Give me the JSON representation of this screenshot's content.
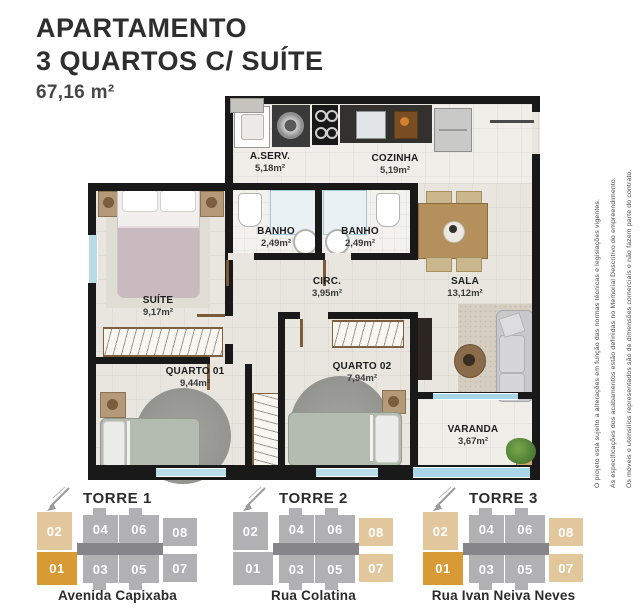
{
  "header": {
    "line1": "APARTAMENTO",
    "line2": "3 QUARTOS C/ SUÍTE",
    "area": "67,16 m²"
  },
  "disclaimer": {
    "line1": "Os móveis e utensílios representados são de dimensões comerciais e não fazem parte do contrato.",
    "line2": "As especificações dos acabamentos estão definidas no Memorial Descritivo do empreendimento.",
    "line3": "O projeto está sujeito a alterações em função das normas técnicas e legislações vigentes."
  },
  "floorplan": {
    "rooms": [
      {
        "name": "A.SERV.",
        "area": "5,18m²"
      },
      {
        "name": "COZINHA",
        "area": "5,19m²"
      },
      {
        "name": "BANHO",
        "area": "2,49m²"
      },
      {
        "name": "BANHO",
        "area": "2,49m²"
      },
      {
        "name": "CIRC.",
        "area": "3,95m²"
      },
      {
        "name": "SALA",
        "area": "13,12m²"
      },
      {
        "name": "SUÍTE",
        "area": "9,17m²"
      },
      {
        "name": "QUARTO 01",
        "area": "9,44m²"
      },
      {
        "name": "QUARTO 02",
        "area": "7,94m²"
      },
      {
        "name": "VARANDA",
        "area": "3,67m²"
      }
    ]
  },
  "towers": [
    {
      "name": "TORRE 1",
      "street": "Avenida Capixaba",
      "units": [
        {
          "label": "02",
          "color": "beige"
        },
        {
          "label": "04",
          "color": "gray"
        },
        {
          "label": "06",
          "color": "gray"
        },
        {
          "label": "08",
          "color": "gray"
        },
        {
          "label": "01",
          "color": "orange"
        },
        {
          "label": "03",
          "color": "gray"
        },
        {
          "label": "05",
          "color": "gray"
        },
        {
          "label": "07",
          "color": "gray"
        }
      ]
    },
    {
      "name": "TORRE 2",
      "street": "Rua Colatina",
      "units": [
        {
          "label": "02",
          "color": "gray"
        },
        {
          "label": "04",
          "color": "gray"
        },
        {
          "label": "06",
          "color": "gray"
        },
        {
          "label": "08",
          "color": "beige"
        },
        {
          "label": "01",
          "color": "gray"
        },
        {
          "label": "03",
          "color": "gray"
        },
        {
          "label": "05",
          "color": "gray"
        },
        {
          "label": "07",
          "color": "beige"
        }
      ]
    },
    {
      "name": "TORRE 3",
      "street": "Rua Ivan Neiva Neves",
      "units": [
        {
          "label": "02",
          "color": "beige"
        },
        {
          "label": "04",
          "color": "gray"
        },
        {
          "label": "06",
          "color": "gray"
        },
        {
          "label": "08",
          "color": "beige"
        },
        {
          "label": "01",
          "color": "orange"
        },
        {
          "label": "03",
          "color": "gray"
        },
        {
          "label": "05",
          "color": "gray"
        },
        {
          "label": "07",
          "color": "beige"
        }
      ]
    }
  ],
  "palette": {
    "gray": "#b1b1b3",
    "beige": "#e3c79c",
    "orange": "#d89a35",
    "corridor": "#85858a"
  }
}
